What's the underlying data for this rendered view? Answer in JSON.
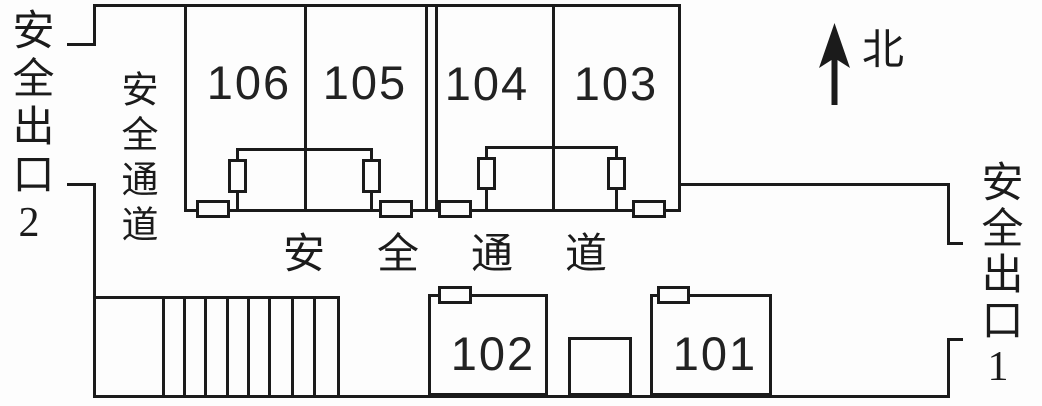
{
  "diagram": {
    "kind": "evacuation-floor-plan",
    "colors": {
      "ink": "#1b1b1b",
      "paper": "#fdfdfd"
    },
    "labels": {
      "exit_left": "安全出口2",
      "exit_right": "安全出口1",
      "corridor_vertical": "安全通道",
      "corridor_horizontal": "安全通道",
      "north": "北"
    },
    "rooms": {
      "top": [
        "106",
        "105",
        "104",
        "103"
      ],
      "bottom": [
        "102",
        "101"
      ]
    },
    "symbols": {
      "emergency_lamp_count": 4,
      "exit_light_count": 6,
      "stair_step_count": 8
    }
  }
}
